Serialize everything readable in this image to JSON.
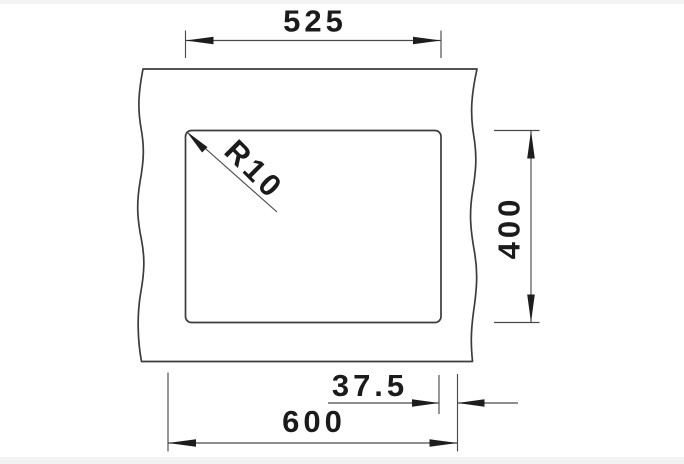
{
  "drawing": {
    "description": "Technical installation drawing of a rectangular sink cutout with break lines in the surrounding countertop",
    "dimensions": {
      "cutout_width": "525",
      "cutout_depth": "400",
      "side_offset": "37.5",
      "cabinet_width": "600",
      "corner_radius": "R10"
    },
    "colors": {
      "background": "#ffffff",
      "strip": "#f3f3f5",
      "outline": "#3c3c3c",
      "dimension_line": "#4a4a4a",
      "text": "#1b1b1b"
    }
  }
}
